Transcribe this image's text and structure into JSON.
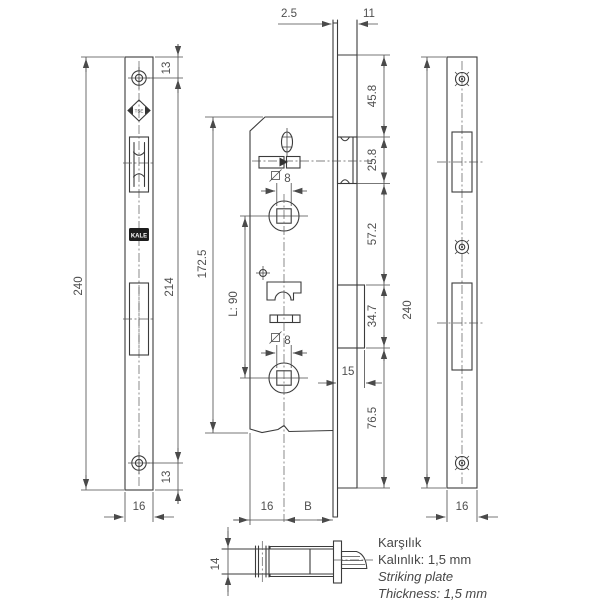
{
  "drawing": {
    "dimensions": {
      "faceplate_thickness": "2.5",
      "latch_protrusion": "11",
      "screw_top_offset": "13",
      "screw_bottom_offset": "13",
      "left_plate_height": "240",
      "screw_spacing": "214",
      "left_plate_width": "16",
      "case_height": "172.5",
      "follower_spacing": "L: 90",
      "spindle_top": "8",
      "spindle_bottom": "8",
      "seg_top_to_latch": "45.8",
      "latch_height": "25.8",
      "latch_to_bolt": "57.2",
      "bolt_height": "34.7",
      "bolt_to_bottom": "76.5",
      "bolt_throw": "15",
      "case_edge_to_spindle": "16",
      "backset": "B",
      "right_plate_height": "240",
      "right_plate_width": "16",
      "section_height": "14"
    },
    "logos": {
      "tse": "TSE",
      "kale": "KALE"
    },
    "notes": {
      "line1_tr": "Karşılık",
      "line2_tr": "Kalınlık: 1,5 mm",
      "line3_en": "Striking plate",
      "line4_en": "Thickness: 1,5 mm"
    }
  }
}
